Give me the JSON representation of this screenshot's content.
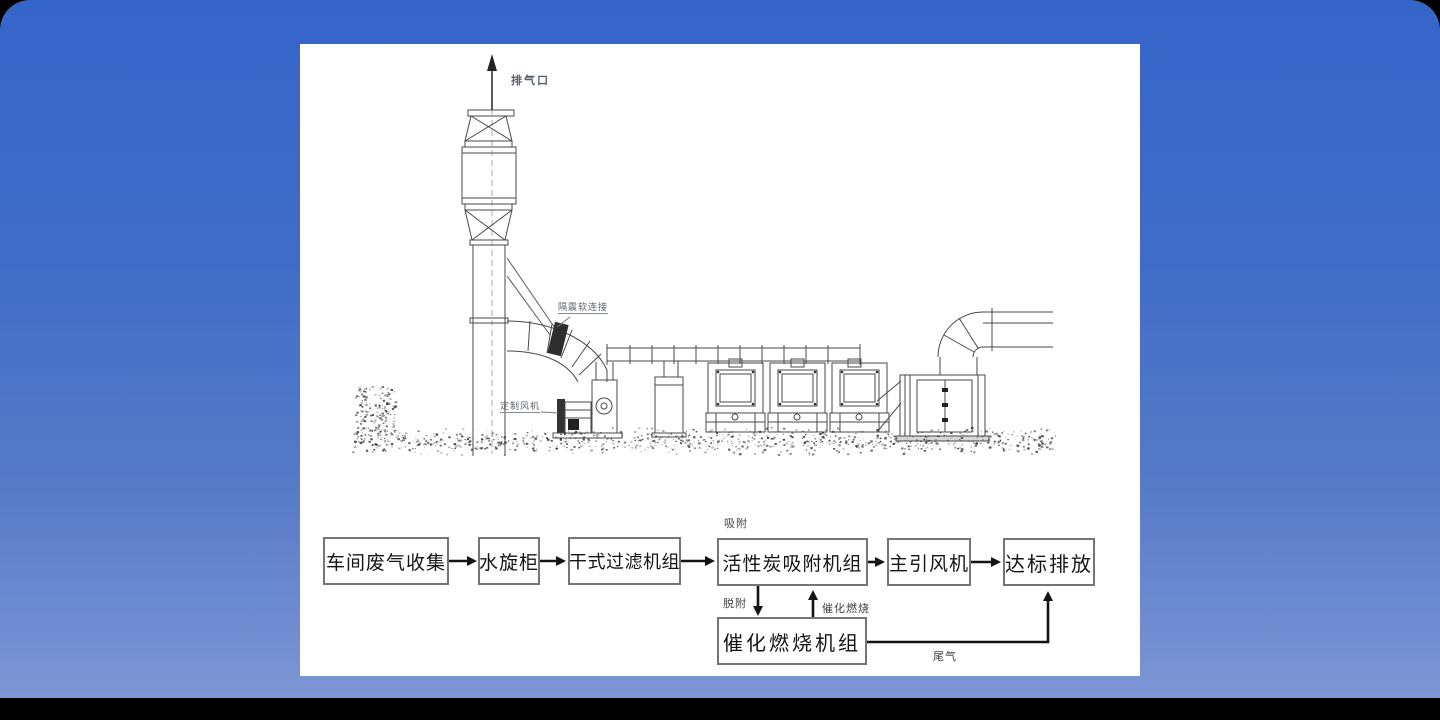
{
  "colors": {
    "background_top": "#3565c9",
    "background_bottom": "#7e96d4",
    "panel": "#ffffff",
    "line_art": "#4a4a4a",
    "arrow": "#141414"
  },
  "drawing": {
    "labels": {
      "exhaust_outlet": "排气口",
      "flex_connector": "隔震软连接",
      "custom_fan": "定制风机"
    }
  },
  "flowchart": {
    "boxes": [
      {
        "label": "车间废气收集"
      },
      {
        "label": "水旋柜"
      },
      {
        "label": "干式过滤机组"
      },
      {
        "label": "活性炭吸附机组"
      },
      {
        "label": "主引风机"
      },
      {
        "label": "达标排放"
      },
      {
        "label": "催化燃烧机组"
      }
    ],
    "annotations": {
      "adsorption": "吸附",
      "desorption": "脱附",
      "catalytic_combustion": "催化燃烧",
      "tail_gas": "尾气"
    }
  }
}
